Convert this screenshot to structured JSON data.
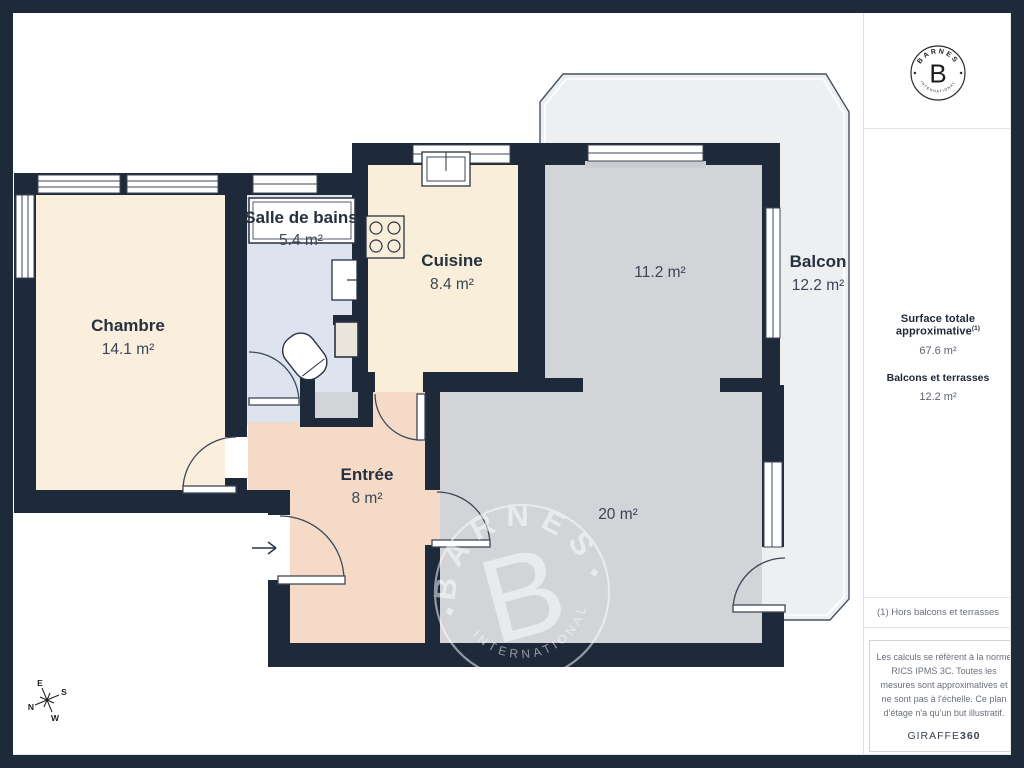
{
  "brand": {
    "name": "BARNES",
    "initial": "B",
    "subtitle": "INTERNATIONAL"
  },
  "sidebar": {
    "summary": {
      "title": "Surface totale approximative",
      "title_sup": "(1)",
      "total_value": "67.6 m²",
      "balconies_label": "Balcons et terrasses",
      "balconies_value": "12.2 m²"
    },
    "footnote": "(1) Hors balcons et terrasses",
    "disclaimer": "Les calculs se réfèrent à la norme RICS IPMS 3C. Toutes les mesures sont approximatives et ne sont pas à l'échelle. Ce plan d'étage n'a qu'un but illustratif.",
    "provider": {
      "name": "GIRAFFE",
      "suffix": "360"
    }
  },
  "plan": {
    "rooms": [
      {
        "id": "chambre",
        "name": "Chambre",
        "area": "14.1 m²"
      },
      {
        "id": "salle-de-bains",
        "name": "Salle de bains",
        "area": "5.4 m²"
      },
      {
        "id": "cuisine",
        "name": "Cuisine",
        "area": "8.4 m²"
      },
      {
        "id": "piece-11",
        "name": "",
        "area": "11.2 m²"
      },
      {
        "id": "entree",
        "name": "Entrée",
        "area": "8 m²"
      },
      {
        "id": "piece-20",
        "name": "",
        "area": "20 m²"
      },
      {
        "id": "balcon",
        "name": "Balcon",
        "area": "12.2 m²"
      }
    ],
    "compass": {
      "east": "E",
      "south": "S",
      "north": "N",
      "west": "W"
    },
    "colors": {
      "wall": "#1e2939",
      "bedroom": "#faeedd",
      "kitchen": "#f8eeda",
      "bathroom": "#dde4f0",
      "gray_room": "#d2d4d7",
      "entry": "#f5dbc7",
      "balcony": "#edeff1"
    }
  }
}
